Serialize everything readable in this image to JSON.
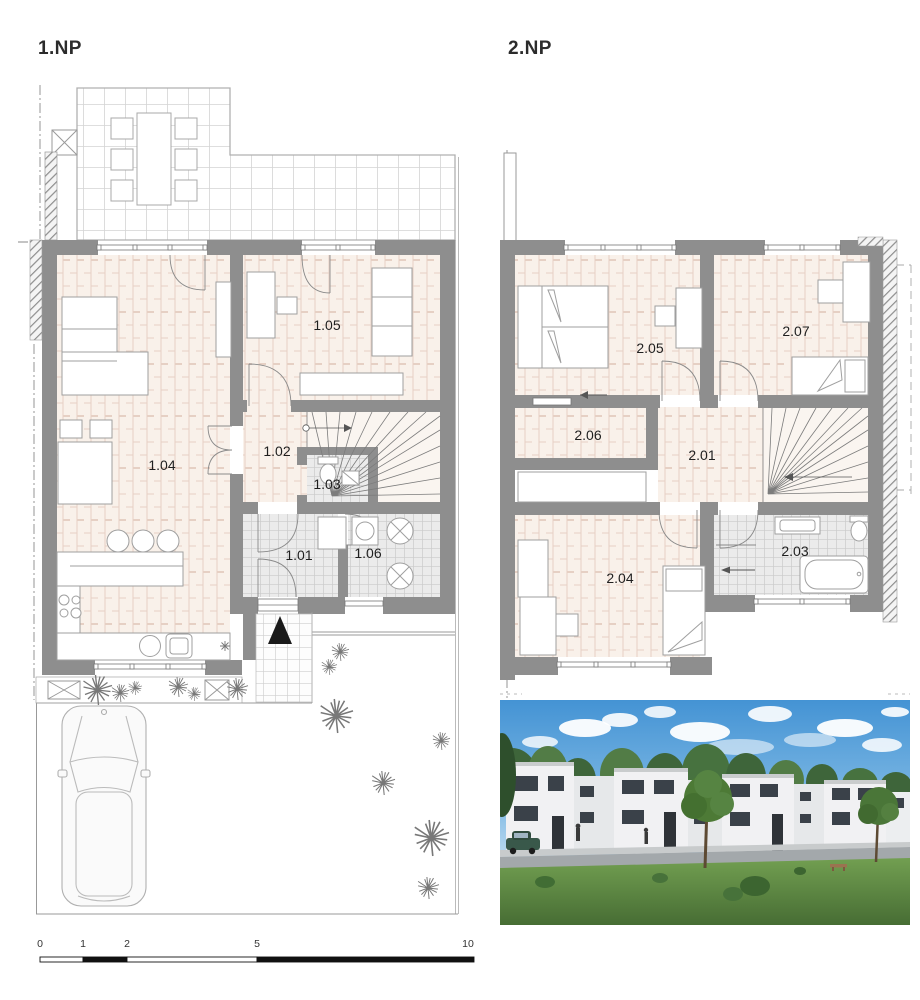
{
  "floor1": {
    "title": "1.NP",
    "rooms": {
      "r101": "1.01",
      "r102": "1.02",
      "r103": "1.03",
      "r104": "1.04",
      "r105": "1.05",
      "r106": "1.06"
    }
  },
  "floor2": {
    "title": "2.NP",
    "rooms": {
      "r201": "2.01",
      "r203": "2.03",
      "r204": "2.04",
      "r205": "2.05",
      "r206": "2.06",
      "r207": "2.07"
    }
  },
  "scalebar": {
    "ticks": [
      "0",
      "1",
      "2",
      "5",
      "10"
    ]
  },
  "colors": {
    "wall": "#8e8e8e",
    "wood_floor": "#f9f1ea",
    "wood_joint": "#e6d0c4",
    "tile_floor": "#ebebeb",
    "tile_line": "#c9c9c9",
    "hatch_line": "#8d8d8d",
    "label": "#1f1f1f",
    "sky": "#4493d4",
    "grass": "#5e8a41",
    "render_house": "#f1f1f3",
    "render_window": "#3a4149",
    "road": "#a3a8ab",
    "car_green": "#39584a"
  },
  "icons": {
    "entrance-arrow": "solid black triangle pointing up",
    "shrub": "radial starburst of lines",
    "planter": "rectangle with X cross",
    "washer-dryer": "circle with X cross",
    "stairs": "radial fan of treads with direction arrow",
    "scale-bar": "alternating black and white bar segments"
  }
}
